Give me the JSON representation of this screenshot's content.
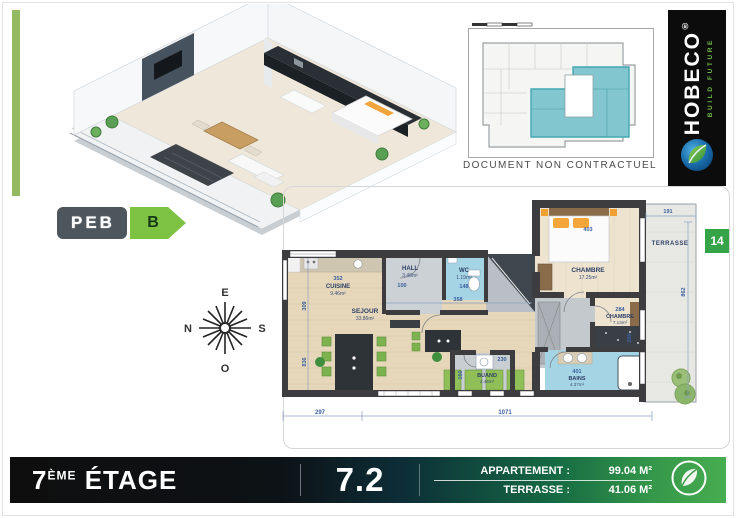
{
  "peb": {
    "label": "PEB",
    "grade": "B"
  },
  "brand": {
    "name": "HOBECO",
    "registered": "®",
    "tagline": "BUILD FUTURE"
  },
  "overview": {
    "caption": "DOCUMENT NON CONTRACTUEL"
  },
  "compass": {
    "top": "E",
    "right": "S",
    "bottom": "O",
    "left": "N"
  },
  "unit_badge": "14",
  "plan": {
    "rooms": {
      "terrasse": {
        "name": "TERRASSE"
      },
      "chambre1": {
        "name": "CHAMBRE",
        "area": "17.25m²",
        "dim": "403"
      },
      "cuisine": {
        "name": "CUISINE",
        "area": "9.46m²",
        "dim": "352"
      },
      "hall": {
        "name": "HALL",
        "area": "3.48m²",
        "dim": "100"
      },
      "wc": {
        "name": "WC",
        "area": "1.19m²",
        "dim": "148"
      },
      "sejour": {
        "name": "SEJOUR",
        "area": "33.86m²"
      },
      "chambre2": {
        "name": "CHAMBRE",
        "area": "7.13m²",
        "dim": "284"
      },
      "bains": {
        "name": "BAINS",
        "area": "4.37m²",
        "dim": "401"
      },
      "buand": {
        "name": "BUAND",
        "area": "2.46m²",
        "dim": "150"
      }
    },
    "dims": {
      "terrace_top": "191",
      "terrace_right": "862",
      "bottom_left": "297",
      "bottom_right": "1071",
      "left_upper": "309",
      "left_lower": "836",
      "hall_bottom": "358",
      "buand_top": "230",
      "chambre2_right": "280"
    }
  },
  "footer": {
    "floor_number": "7",
    "floor_suffix": "ÈME",
    "floor_label": "ÉTAGE",
    "unit_number": "7.2",
    "apartment_label": "APPARTEMENT :",
    "apartment_area": "99.04 M²",
    "terrace_label": "TERRASSE :",
    "terrace_area": "41.06 M²"
  }
}
